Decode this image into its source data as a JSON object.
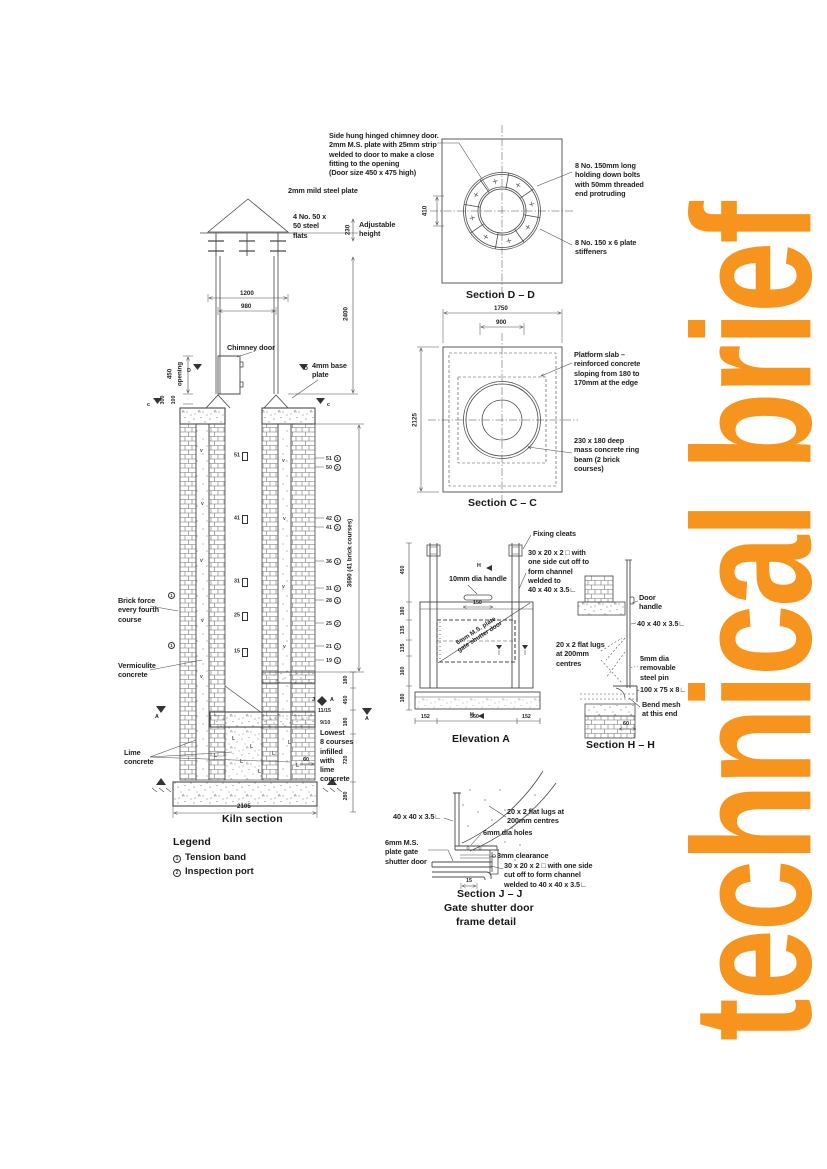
{
  "page": {
    "side_title": "technical brief",
    "accent": "#F7941D"
  },
  "top_note": {
    "text": "Side hung hinged chimney door.\n2mm M.S. plate with 25mm strip\nwelded to door to make a close\nfitting to the opening\n(Door size 450 x 475 high)"
  },
  "cap": {
    "mild_steel_plate": "2mm mild steel plate",
    "steel_flats": "4 No. 50 x\n50 steel\nflats",
    "adjustable_height": "Adjustable\nheight",
    "dim_adjust": "230",
    "dim_1200": "1200",
    "dim_980": "980",
    "dim_2400": "2400",
    "chimney_door": "Chimney door",
    "base_plate": "4mm base\nplate",
    "dim_opening": "450",
    "opening_word": "opening",
    "dim_300": "300",
    "dim_100": "100"
  },
  "section_dd": {
    "title": "Section D – D",
    "dim_410": "410",
    "bolts_note": "8 No. 150mm long\nholding down bolts\nwith 50mm threaded\nend protruding",
    "stiffeners_note": "8 No. 150 x 6 plate\nstiffeners"
  },
  "section_cc": {
    "title": "Section C – C",
    "dim_1750": "1750",
    "dim_900": "900",
    "dim_2125": "2125",
    "platform_note": "Platform slab –\nreinforced concrete\nsloping from 180 to\n170mm at the edge",
    "ring_beam_note": "230 x 180 deep\nmass concrete ring\nbeam (2 brick\ncourses)"
  },
  "kiln": {
    "title": "Kiln section",
    "brick_force": "Brick force\nevery fourth\ncourse",
    "vermiculite": "Vermiculite\nconcrete",
    "lime": "Lime\nconcrete",
    "lowest": "Lowest\n8 courses\ninfilled\nwith\nlime\nconcrete",
    "dim_total": "3690 (41 brick courses)",
    "dim_2105": "2105",
    "dim_60": "60",
    "right_dims": [
      "180",
      "450",
      "180",
      "720",
      "280"
    ],
    "fractions": [
      "11/15",
      "9/10"
    ],
    "course_rows": [
      {
        "n": "51",
        "c": "1"
      },
      {
        "n": "50",
        "c": "2"
      },
      {
        "n": "42",
        "c": "1"
      },
      {
        "n": "41",
        "c": "2"
      },
      {
        "n": "36",
        "c": "1"
      },
      {
        "n": "31",
        "c": "2"
      },
      {
        "n": "28",
        "c": "1"
      },
      {
        "n": "25",
        "c": "2"
      },
      {
        "n": "21",
        "c": "1"
      },
      {
        "n": "19",
        "c": "1"
      }
    ],
    "ports": [
      "51",
      "41",
      "31",
      "25",
      "15"
    ],
    "markers": {
      "c": "c",
      "d": "D",
      "a": "A",
      "j": "J"
    },
    "hatch_v": "v",
    "hatch_l": "L"
  },
  "elevation_a": {
    "title": "Elevation A",
    "fixing_cleats": "Fixing cleats",
    "channel_note": "30 x 20 x 2 □ with\none side cut off to\nform channel\nwelded to\n40 x 40 x 3.5∟",
    "handle_note": "10mm dia handle",
    "lugs_note": "20 x 2 flat lugs\nat 200mm\ncentres",
    "diag_label": "6mm M.S. plate\ngate shutter door",
    "dim_150": "150",
    "left_dims": [
      "450",
      "180",
      "135",
      "135",
      "160",
      "180"
    ],
    "bottom_dims": [
      "152",
      "560",
      "152"
    ],
    "marker_h": "H"
  },
  "section_hh": {
    "title": "Section H – H",
    "door_handle": "Door\nhandle",
    "angle_40": "40 x 40 x 3.5∟",
    "pin_note": "5mm dia\nremovable\nsteel pin",
    "angle_100": "100 x 75 x 8∟",
    "bend_note": "Bend mesh\nat this end",
    "dim_60": "60"
  },
  "section_jj": {
    "title": "Section J – J",
    "subtitle1": "Gate shutter door",
    "subtitle2": "frame detail",
    "angle_40": "40 x 40 x 3.5∟",
    "lugs_note": "20 x 2 flat lugs at\n200mm centres",
    "holes_note": "6mm dia holes",
    "plate_note": "6mm M.S.\nplate gate\nshutter door",
    "clearance_note": "3mm clearance",
    "channel_note": "30 x 20 x 2 □ with one side\ncut off to form channel\nwelded to 40 x 40 x 3.5∟",
    "dim_15": "15"
  },
  "legend": {
    "title": "Legend",
    "items": [
      {
        "num": "1",
        "label": "Tension band"
      },
      {
        "num": "2",
        "label": "Inspection port"
      }
    ]
  }
}
